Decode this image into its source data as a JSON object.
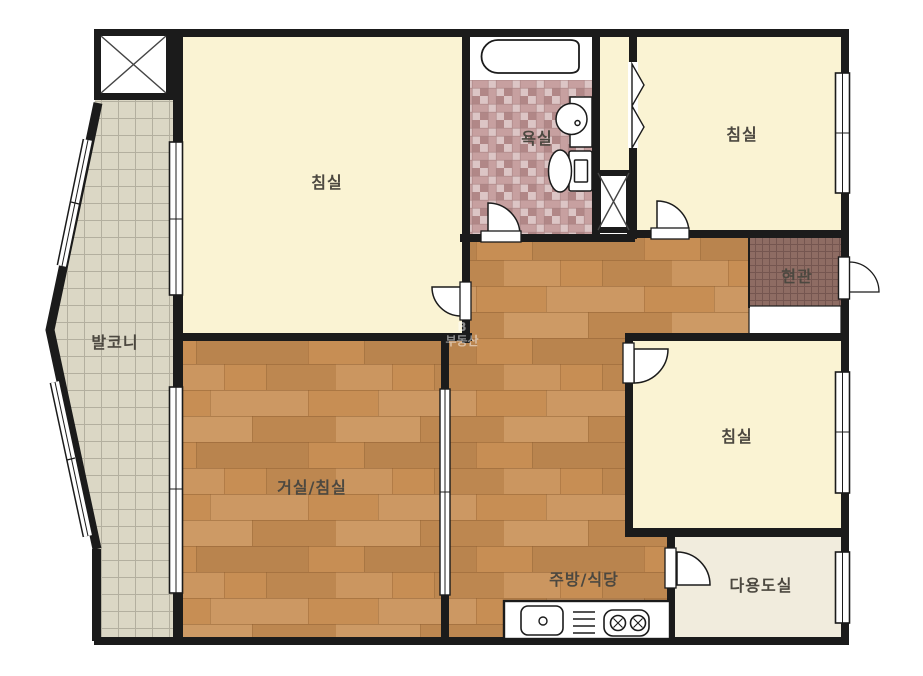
{
  "plan_type": "apartment-floorplan",
  "rooms": {
    "balcony": {
      "label": "발코니"
    },
    "bedroom_top_left": {
      "label": "침실"
    },
    "bathroom": {
      "label": "욕실"
    },
    "bedroom_top_right": {
      "label": "침실"
    },
    "entrance": {
      "label": "현관"
    },
    "living_bedroom": {
      "label": "거실/침실"
    },
    "bedroom_right": {
      "label": "침실"
    },
    "kitchen_dining": {
      "label": "주방/식당"
    },
    "utility_room": {
      "label": "다용도실"
    }
  },
  "watermark": {
    "line1": "B",
    "line2": "부동산"
  },
  "fixtures": {
    "bathtub": "bathtub",
    "wash_basin": "wash-basin",
    "toilet": "toilet",
    "kitchen_sink": "kitchen-sink",
    "dish_rack": "dish-rack",
    "gas_stove": "gas-stove-2-burners",
    "duct_shaft_top_left": "duct-shaft",
    "duct_shaft_center": "duct-shaft",
    "front_door": "front-door",
    "closet_bifold": "bifold-closet-door"
  },
  "colors": {
    "wall": "#1b1b1b",
    "bedroom_floor": "#faf3d3",
    "wood_base": "#c78e54",
    "balcony_base": "#dbd7c5",
    "balcony_grid": "#b3af9f",
    "bath_tile_base": "#c7a0a0",
    "bath_tile_light": "#dcc5c5",
    "bath_tile_dark": "#b18787",
    "entrance_base": "#8e6c63",
    "entrance_grid": "#755650",
    "utility_floor": "#f1ecdd",
    "fixture_fill": "#ffffff",
    "label_text": "#4c4840",
    "watermark_text": "#ffffff"
  }
}
